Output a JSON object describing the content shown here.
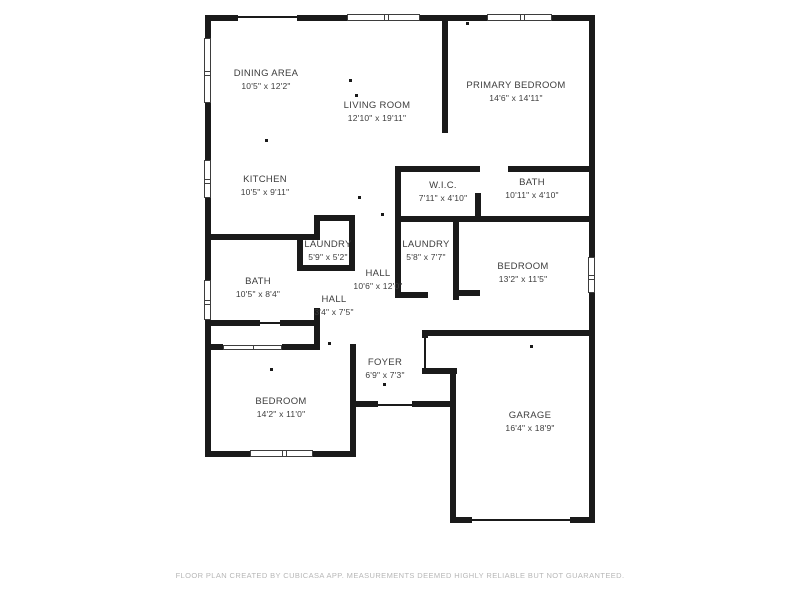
{
  "rooms": [
    {
      "name": "DINING AREA",
      "dims": "10'5\" x 12'2\""
    },
    {
      "name": "LIVING ROOM",
      "dims": "12'10\" x 19'11\""
    },
    {
      "name": "PRIMARY BEDROOM",
      "dims": "14'6\" x 14'11\""
    },
    {
      "name": "KITCHEN",
      "dims": "10'5\" x 9'11\""
    },
    {
      "name": "W.I.C.",
      "dims": "7'11\" x 4'10\""
    },
    {
      "name": "BATH",
      "dims": "10'11\" x 4'10\""
    },
    {
      "name": "LAUNDRY",
      "dims": "5'9\" x 5'2\""
    },
    {
      "name": "LAUNDRY",
      "dims": "5'8\" x 7'7\""
    },
    {
      "name": "HALL",
      "dims": "10'6\" x 12'0\""
    },
    {
      "name": "BATH",
      "dims": "10'5\" x 8'4\""
    },
    {
      "name": "HALL",
      "dims": "3'4\" x 7'5\""
    },
    {
      "name": "BEDROOM",
      "dims": "13'2\" x 11'5\""
    },
    {
      "name": "FOYER",
      "dims": "6'9\" x 7'3\""
    },
    {
      "name": "BEDROOM",
      "dims": "14'2\" x 11'0\""
    },
    {
      "name": "GARAGE",
      "dims": "16'4\" x 18'9\""
    }
  ],
  "footer": "FLOOR PLAN CREATED BY CUBICASA APP. MEASUREMENTS DEEMED HIGHLY RELIABLE BUT NOT GUARANTEED.",
  "colors": {
    "wall": "#1a1a1a",
    "background": "#ffffff",
    "label": "#3d3d3d",
    "footer": "#b7b7b7"
  }
}
